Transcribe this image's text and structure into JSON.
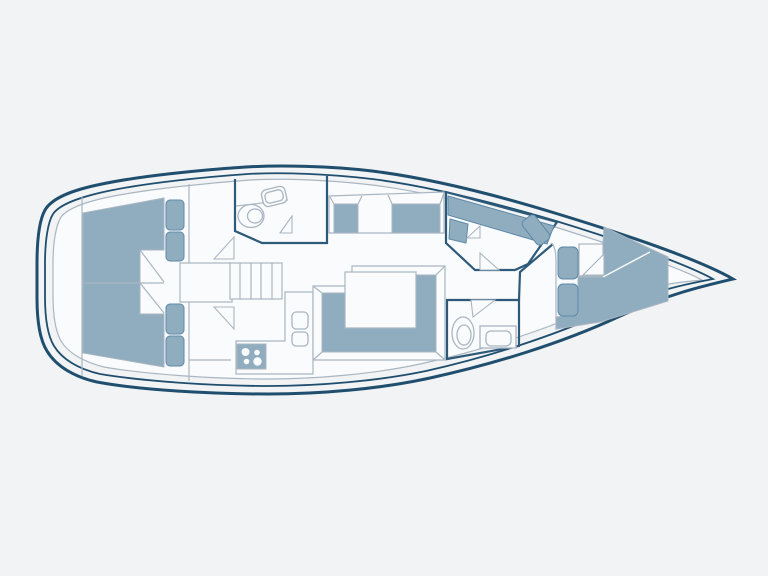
{
  "meta": {
    "type": "floor-plan-diagram",
    "subject": "Sailing yacht interior layout, top view, bow pointing right",
    "visible_text": []
  },
  "colors": {
    "background": "#f1f3f4",
    "hull": "#1f4e6e",
    "room": "#fafbfc",
    "wall-light": "#a9b6c2",
    "wall-dark": "#2e5a7a",
    "furniture": "#8fadbf",
    "furniture-stroke": "#5d89a8"
  },
  "rooms": [
    {
      "name": "aft-cabin-port",
      "features": [
        "double-berth",
        "two-pillows",
        "door"
      ]
    },
    {
      "name": "aft-cabin-starboard",
      "features": [
        "double-berth",
        "two-pillows",
        "door"
      ]
    },
    {
      "name": "aft-head",
      "features": [
        "toilet",
        "sink",
        "door"
      ]
    },
    {
      "name": "companionway",
      "features": [
        "five-step-stairs",
        "engine-box"
      ]
    },
    {
      "name": "galley",
      "features": [
        "four-burner-stove",
        "double-sink",
        "l-counter"
      ]
    },
    {
      "name": "salon",
      "features": [
        "port-bench-two-cushions",
        "u-shaped-settee",
        "table"
      ]
    },
    {
      "name": "nav-station",
      "features": [
        "chart-desk",
        "chair",
        "seat"
      ]
    },
    {
      "name": "forward-head",
      "features": [
        "toilet",
        "sink",
        "door"
      ]
    },
    {
      "name": "forward-cabin",
      "features": [
        "v-berth",
        "two-pillows",
        "door"
      ]
    }
  ]
}
